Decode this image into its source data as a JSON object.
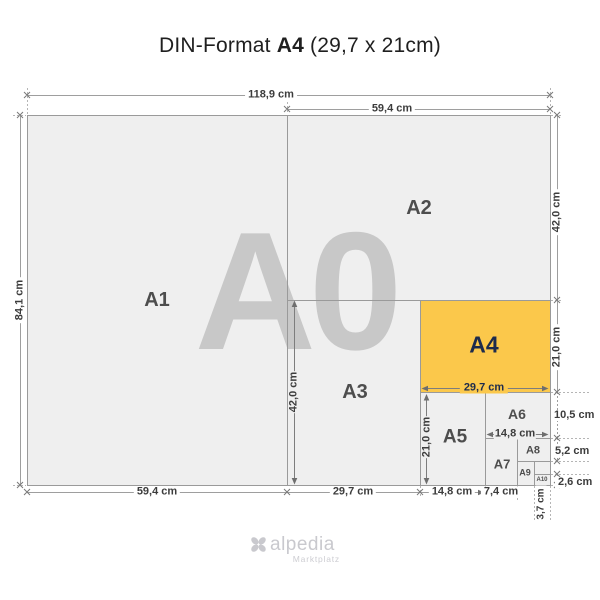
{
  "title": {
    "prefix": "DIN-Format ",
    "format": "A4",
    "size": " (29,7 x 21cm)"
  },
  "watermark": "A0",
  "labels": {
    "a1": "A1",
    "a2": "A2",
    "a3": "A3",
    "a4": "A4",
    "a5": "A5",
    "a6": "A6",
    "a7": "A7",
    "a8": "A8",
    "a9": "A9",
    "a10": "A10"
  },
  "dimensions": {
    "a0_width": "118,9 cm",
    "a0_height": "84,1 cm",
    "a2_width": "59,4 cm",
    "a2_height": "42,0 cm",
    "a4_height": "21,0 cm",
    "a6_height": "10,5 cm",
    "a8_height": "5,2 cm",
    "a10_height": "2,6 cm",
    "a1_width": "59,4 cm",
    "a3_width": "29,7 cm",
    "a5_width_bottom": "14,8 cm",
    "a7_width": "7,4 cm",
    "a10_width": "3,7 cm",
    "inner_a3_height": "42,0 cm",
    "inner_a5_height": "21,0 cm",
    "inner_a4_width": "29,7 cm",
    "inner_a6_width": "14,8 cm"
  },
  "logo": {
    "name": "alpedia",
    "tagline": "Marktplatz"
  },
  "colors": {
    "highlight_fill": "#FBC84B",
    "highlight_text": "#1D2B4C",
    "sheet_fill": "#EFEFEF",
    "line_gray": "#9A9A9A",
    "watermark_gray": "#C8C8C8",
    "label_gray": "#4D4D4D",
    "logo_gray": "#C9C9CE"
  }
}
